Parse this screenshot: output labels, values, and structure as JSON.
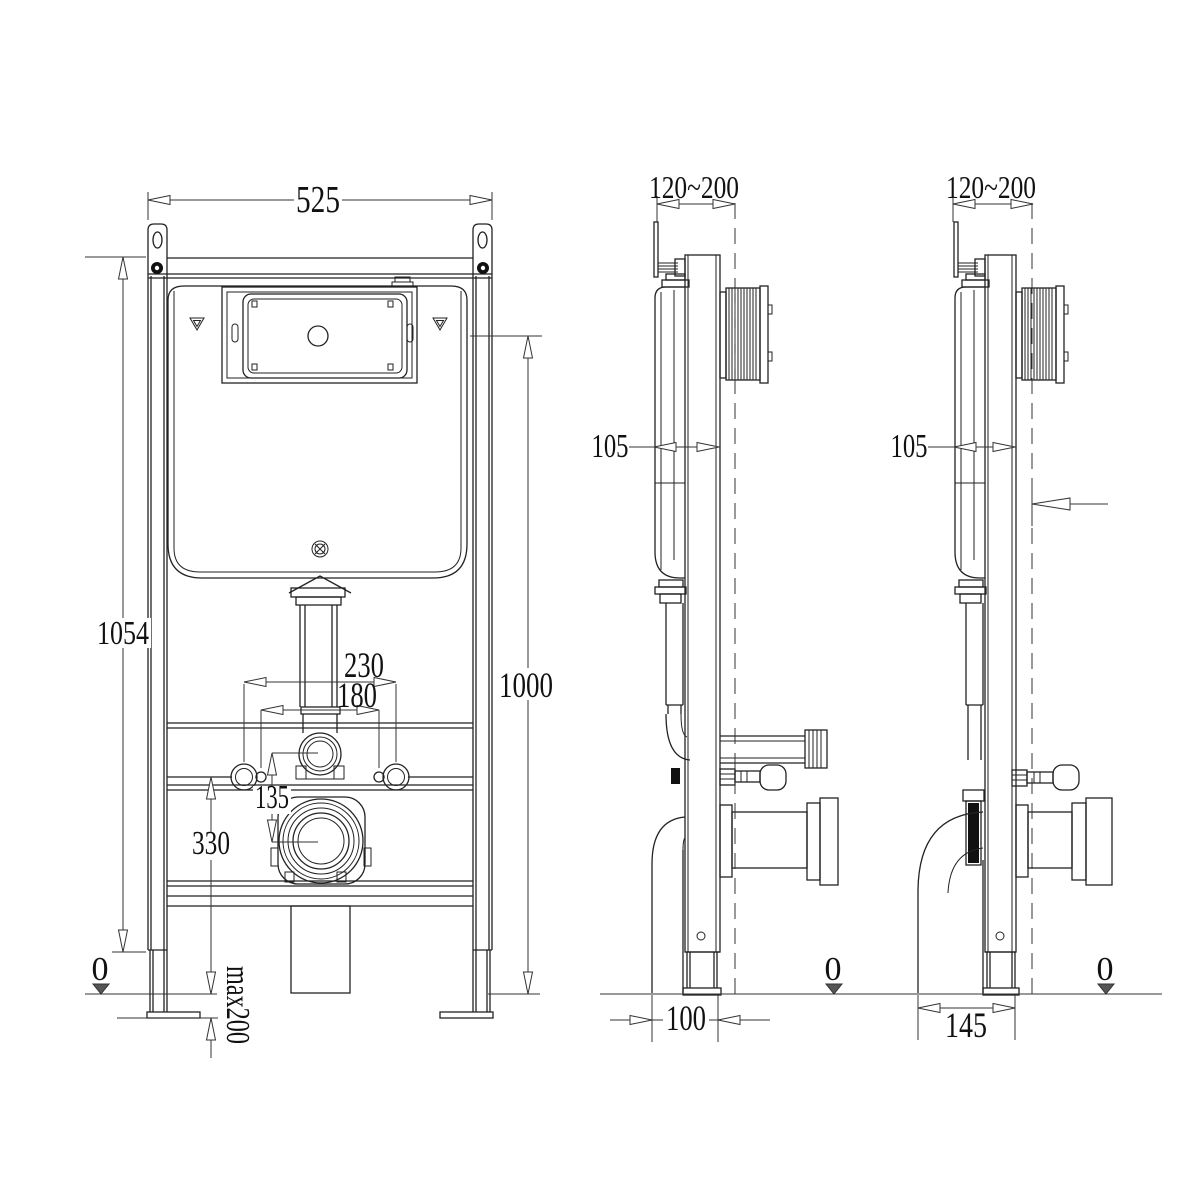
{
  "colors": {
    "background": "#ffffff",
    "line": "#222222",
    "text": "#111111"
  },
  "dimensions": {
    "front_view": {
      "frame_width": "525",
      "frame_height": "1054",
      "flush_plate_center_height": "1000",
      "fixing_bolt_spacing_outer": "230",
      "fixing_bolt_spacing_inner": "180",
      "flush_to_drain_offset": "135",
      "fixing_bolt_height": "330",
      "floor_level": "0",
      "foot_adjustment": "max200"
    },
    "side_view_a": {
      "wall_distance_range": "120~200",
      "frame_depth": "105",
      "drain_offset": "100",
      "floor_level": "0"
    },
    "side_view_b": {
      "wall_distance_range": "120~200",
      "frame_depth": "105",
      "drain_offset": "145",
      "floor_level": "0"
    }
  }
}
